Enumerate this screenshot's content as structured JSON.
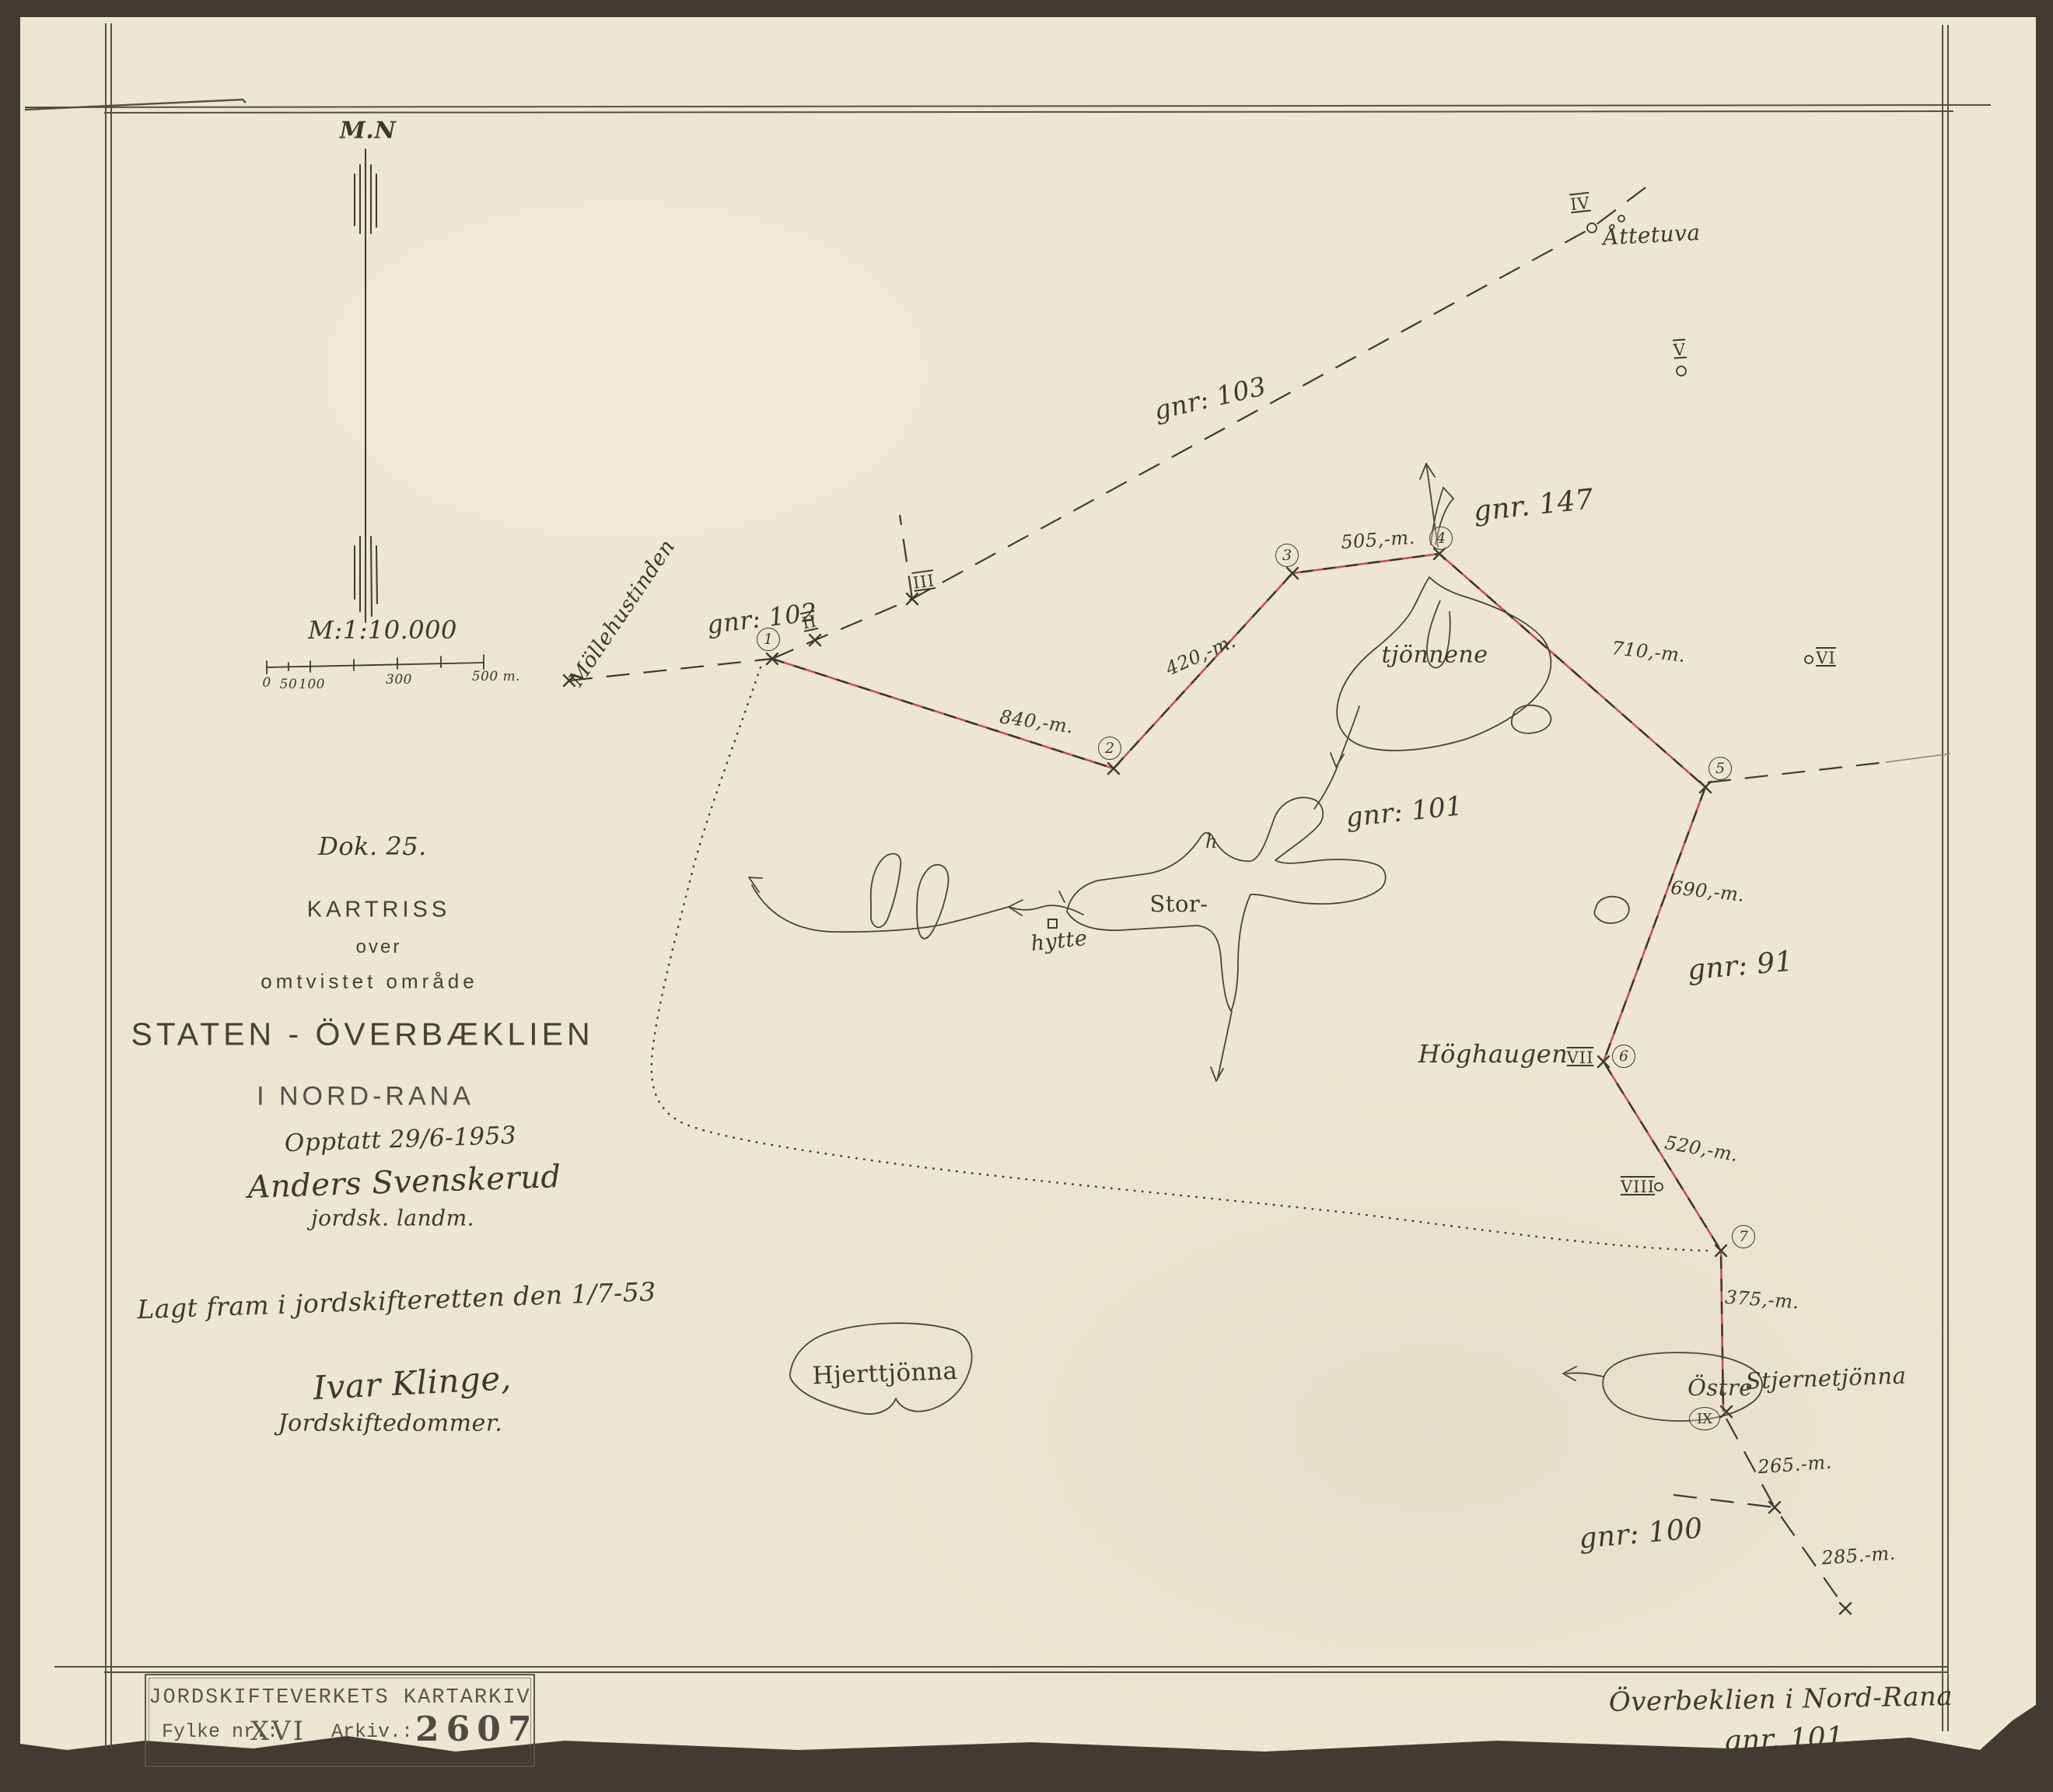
{
  "document_type": "kartriss (hand-drawn cadastral survey map)",
  "colors": {
    "paper": "#ece6d2",
    "backing": "#413b33",
    "ink": "#3f3a32",
    "stamp_ink": "#5a554c",
    "boundary_red": "#c44f63",
    "pencil": "#8d8578"
  },
  "north": {
    "label": "M.N"
  },
  "scale": {
    "label": "M:1:10.000",
    "tick0": "0",
    "tick50": "50",
    "tick100": "100",
    "tick300": "300",
    "tick500": "500 m."
  },
  "title": {
    "doc": "Dok. 25.",
    "heading": "KARTRISS",
    "sub1": "over",
    "sub2": "omtvistet område",
    "main": "STATEN - ÖVERBÆKLIEN",
    "region": "I NORD-RANA",
    "surveyed": "Opptatt 29/6-1953",
    "surveyor": "Anders Svenskerud",
    "surveyor_title": "jordsk. landm.",
    "court": "Lagt fram i jordskifteretten den 1/7-53",
    "judge": "Ivar Klinge,",
    "judge_title": "Jordskiftedommer."
  },
  "stamp": {
    "archive": "JORDSKIFTEVERKETS KARTARKIV",
    "fylke_label": "Fylke nr.:",
    "fylke_value": "XVI",
    "arkiv_label": "Arkiv.:",
    "arkiv_value": "2607"
  },
  "footer": {
    "name": "Överbeklien i Nord-Rana",
    "gnr": "gnr. 101."
  },
  "parcels": {
    "gnr103": "gnr: 103",
    "gnr102": "gnr: 102",
    "gnr147": "gnr. 147",
    "gnr101": "gnr: 101",
    "gnr91": "gnr: 91",
    "gnr100": "gnr: 100"
  },
  "places": {
    "mollehustinden": "Möllehustinden",
    "attetuva": "Åttetuva",
    "tjonnene": "tjönnene",
    "stor": "Stor-",
    "h": "h",
    "hytte": "hytte",
    "hjerttjonna": "Hjerttjönna",
    "hoghaugen": "Höghaugen",
    "ostre": "Östre",
    "stjernetjonna": "Stjernetjönna"
  },
  "points": {
    "p1": "1",
    "p2": "2",
    "p3": "3",
    "p4": "4",
    "p5": "5",
    "p6": "6",
    "p7": "7",
    "pIX": "IX",
    "rII": "II",
    "rIII": "III",
    "rIV": "IV",
    "rV": "V",
    "rVI": "VI",
    "rVII": "VII",
    "rVIII": "VIII"
  },
  "distances": {
    "d840": "840,-m.",
    "d420": "420,-m.",
    "d505": "505,-m.",
    "d710": "710,-m.",
    "d690": "690,-m.",
    "d520": "520,-m.",
    "d375": "375,-m.",
    "d265": "265.-m.",
    "d285": "285.-m."
  }
}
